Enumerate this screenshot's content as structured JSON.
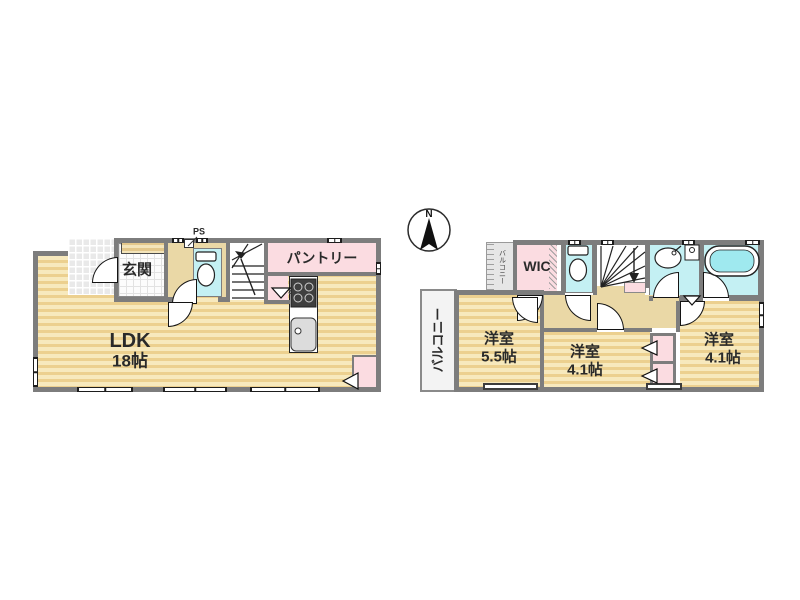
{
  "colors": {
    "wall": "#7d7d7d",
    "wood_floor_light": "#f7e9bd",
    "wood_floor_stripe": "#ecd08f",
    "hall_beige": "#ead8a6",
    "closet_pink": "#fbdce1",
    "wet_area_cyan": "#c4f0f3",
    "tub_water": "#9fe9ef",
    "balcony_gray": "#f3f3f3"
  },
  "floor1": {
    "ps_top": "PS",
    "entrance_label": "玄関",
    "pantry_label": "パントリー",
    "ps_kitchen": "PS",
    "ldk_name": "LDK",
    "ldk_size": "18帖"
  },
  "floor2": {
    "compass_north": "N",
    "balcony_label": "バルコニー",
    "front_balcony_label": "バルコニー",
    "wic_label": "WIC",
    "bedroom_a_name": "洋室",
    "bedroom_a_size": "5.5帖",
    "bedroom_b_name": "洋室",
    "bedroom_b_size": "4.1帖",
    "bedroom_c_name": "洋室",
    "bedroom_c_size": "4.1帖"
  }
}
